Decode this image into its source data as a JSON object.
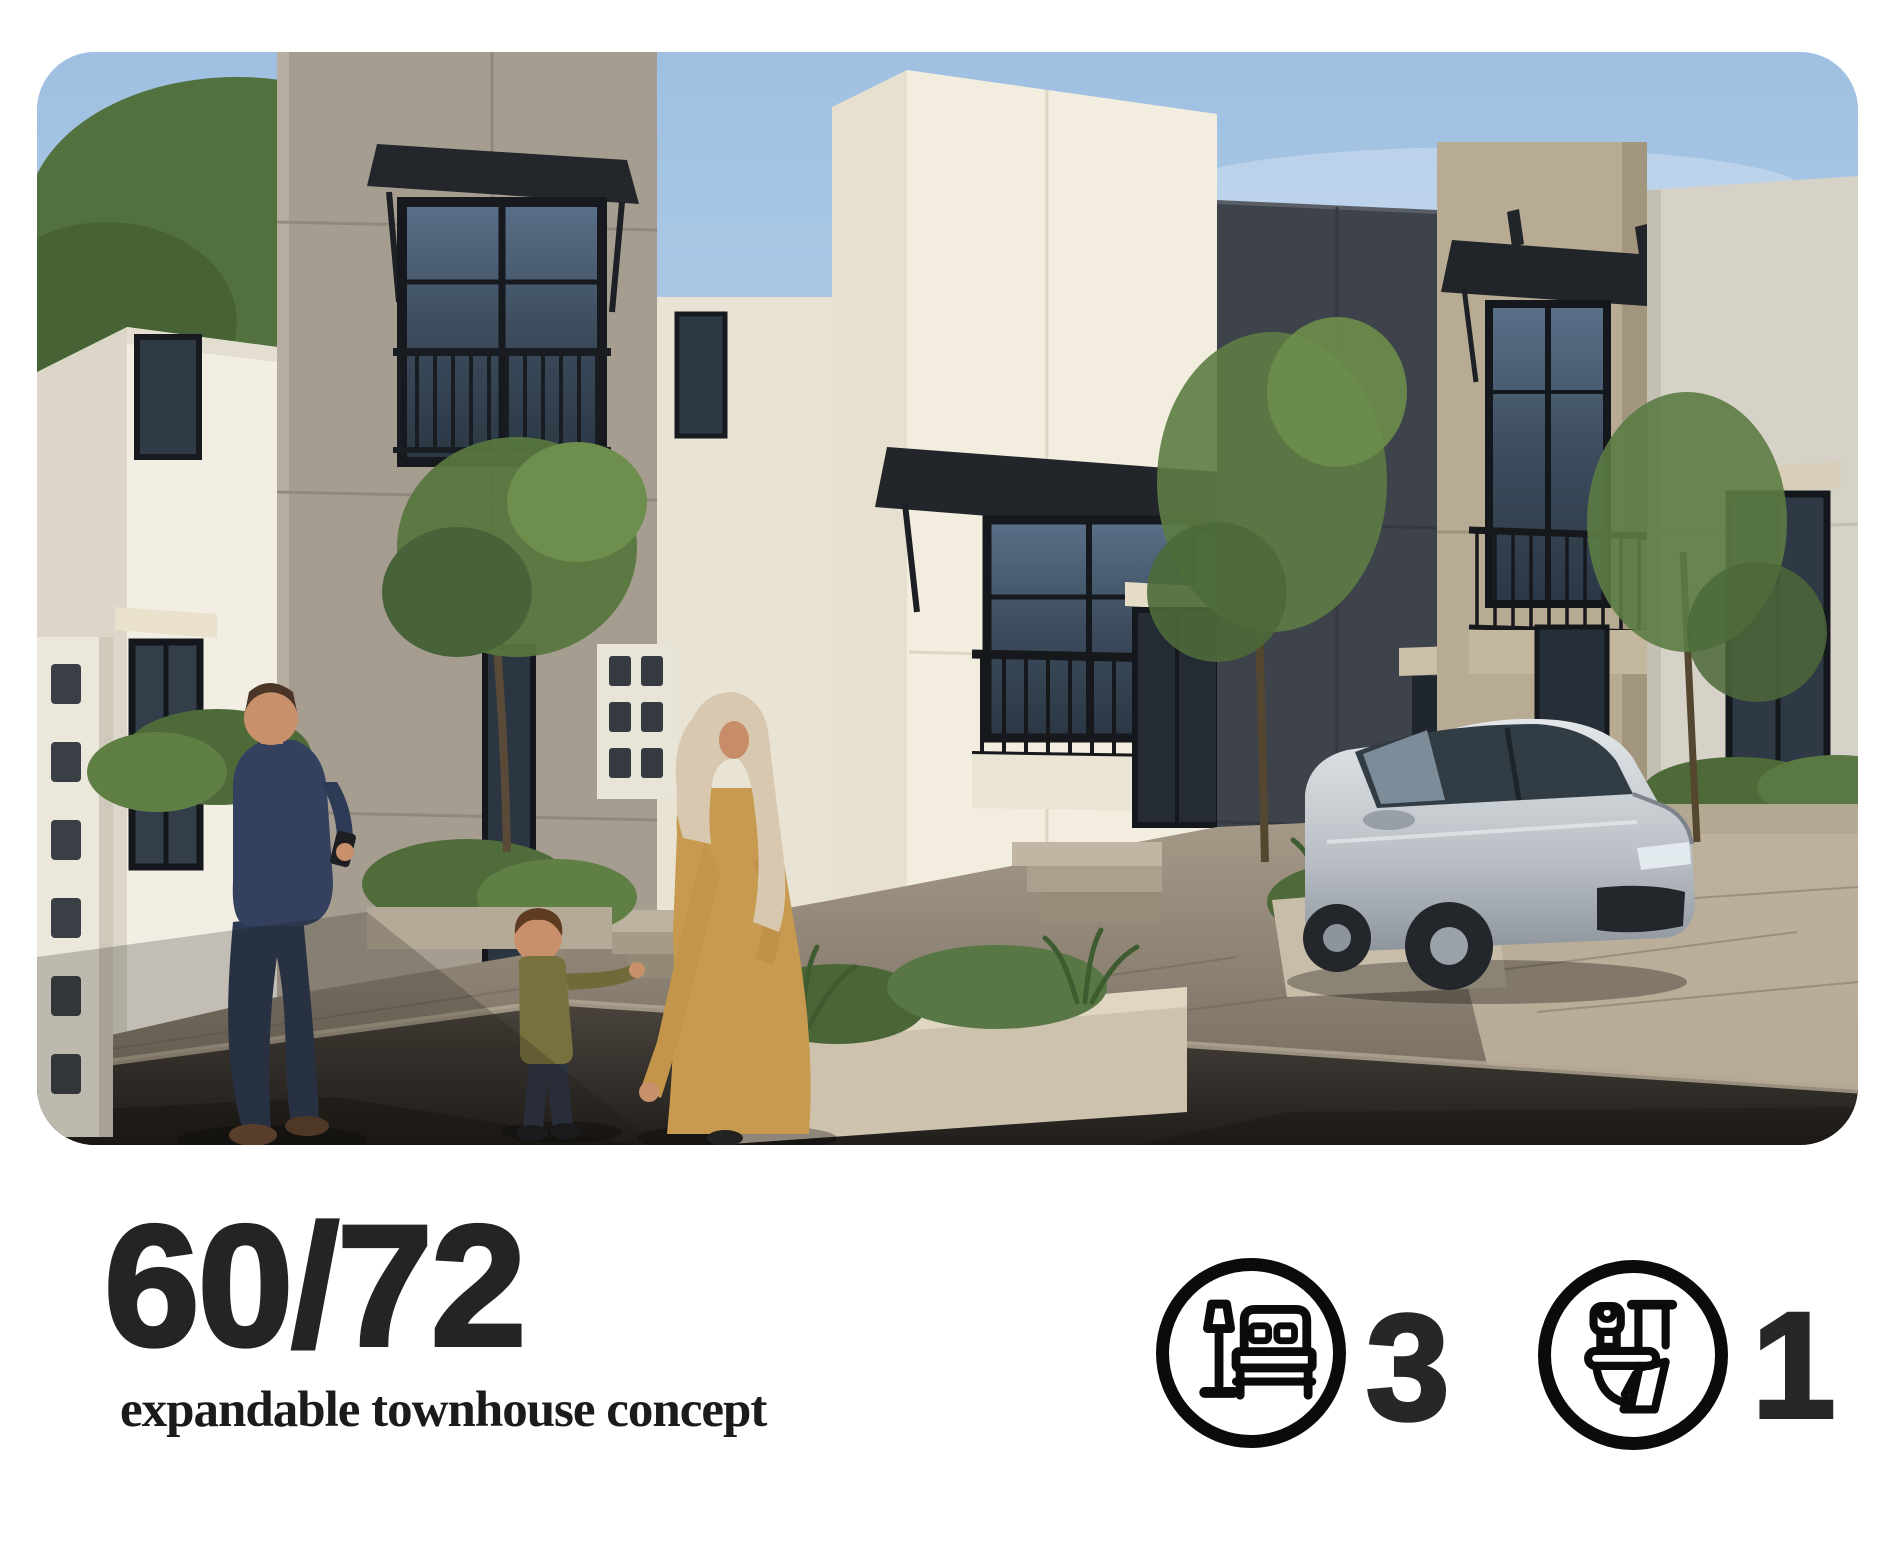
{
  "card": {
    "photo_alt": "Street rendering of modern two-storey townhouses in white, grey and charcoal with black-framed windows, balconies and awnings; a man checking his phone, a woman in a mustard abaya and cream headscarf holding a child's hand, landscaped planters, and a silver sedan parked in a driveway under a clear blue sky",
    "title": "60/72",
    "subtitle": "expandable townhouse concept",
    "specs": [
      {
        "id": "bedrooms",
        "icon": "bed-icon",
        "value": "3"
      },
      {
        "id": "bathrooms",
        "icon": "toilet-icon",
        "value": "1"
      }
    ],
    "colors": {
      "page_background": "#ffffff",
      "text": "#242424",
      "icon_stroke": "#0b0b0b",
      "sky": "#a9c7e5",
      "accent_robe": "#c79a4f"
    }
  }
}
